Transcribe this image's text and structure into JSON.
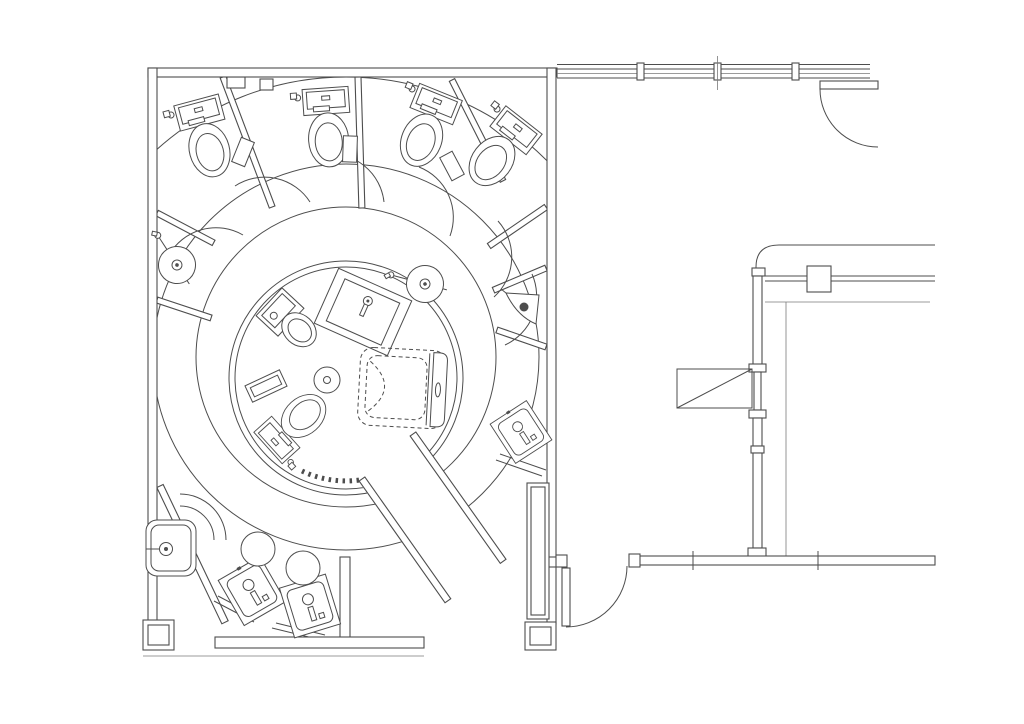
{
  "document": {
    "kind": "architectural floor plan (CAD line drawing, plan view)",
    "scene": "circular restroom suite with radial toilet stalls around a round central wet-room, vanity corner, and an adjacent room to the right",
    "background_color": "#ffffff",
    "line_color": "#4d4d4d",
    "text_visible": false
  },
  "plan": {
    "main_room": {
      "name": "circular-washroom",
      "ring_center": {
        "x": 346,
        "y": 357
      },
      "outer_boundary_radius": 283,
      "ring_radius": 193,
      "corridor_radius": 150,
      "central_room": {
        "center_x": 346,
        "center_y": 378,
        "outer_radius": 117,
        "inner_radius": 111
      },
      "toilet_stall_count": 4,
      "door_arc_count": 8
    },
    "adjacent_room": {
      "name": "side-room",
      "features": [
        "glazed window wall",
        "entry door top-right",
        "entry door bottom-left",
        "counter with block",
        "wall with sidelight",
        "shelf with diagonal"
      ]
    }
  },
  "fixtures": [
    {
      "type": "toilet",
      "name": "toilet-stall-1",
      "x": 196,
      "y": 100,
      "rot": -15
    },
    {
      "type": "toilet",
      "name": "toilet-stall-2",
      "x": 325,
      "y": 88,
      "rot": -4
    },
    {
      "type": "toilet",
      "name": "toilet-stall-3",
      "x": 441,
      "y": 92,
      "rot": 22
    },
    {
      "type": "toilet",
      "name": "toilet-stall-4",
      "x": 524,
      "y": 120,
      "rot": 38
    },
    {
      "type": "toilet",
      "name": "central-toilet",
      "x": 268,
      "y": 448,
      "rot": -132,
      "s": 0.92
    },
    {
      "type": "bidet",
      "name": "central-bidet-sink",
      "x": 280,
      "y": 312,
      "rot": -47
    },
    {
      "type": "fountain",
      "name": "wash-fountain-left",
      "x": 177,
      "y": 265,
      "rot": 12
    },
    {
      "type": "fountain",
      "name": "wash-fountain-right",
      "x": 425,
      "y": 284,
      "rot": -30
    },
    {
      "type": "trisink",
      "name": "corner-sink-triangular",
      "x": 523,
      "y": 307,
      "rot": 0
    },
    {
      "type": "basin",
      "name": "stall-sink-square",
      "x": 521,
      "y": 432,
      "rot": -33,
      "s": 0.9
    },
    {
      "type": "utility",
      "name": "utility-sink",
      "x": 171,
      "y": 548,
      "rot": 0
    },
    {
      "type": "basin",
      "name": "vanity-basin-1",
      "x": 252,
      "y": 591,
      "rot": -30
    },
    {
      "type": "basin",
      "name": "vanity-basin-2",
      "x": 310,
      "y": 606,
      "rot": -17
    },
    {
      "type": "stool",
      "name": "stool-1",
      "x": 258,
      "y": 549,
      "rot": 0
    },
    {
      "type": "stool",
      "name": "stool-2",
      "x": 303,
      "y": 568,
      "rot": 0
    },
    {
      "type": "vanity",
      "name": "central-vanity-sink",
      "x": 363,
      "y": 312,
      "rot": 24
    },
    {
      "type": "tub",
      "name": "bathtub",
      "x": 402,
      "y": 388,
      "rot": 3
    },
    {
      "type": "drain",
      "name": "floor-drain",
      "x": 327,
      "y": 380,
      "rot": 0
    },
    {
      "type": "shelf",
      "name": "central-shelf",
      "x": 266,
      "y": 386,
      "rot": -25
    },
    {
      "type": "tp",
      "name": "tp-holder-1",
      "x": 243,
      "y": 152,
      "rot": 22
    },
    {
      "type": "tp",
      "name": "tp-holder-2",
      "x": 350,
      "y": 149,
      "rot": 2
    },
    {
      "type": "tp",
      "name": "tp-holder-3",
      "x": 452,
      "y": 166,
      "rot": -28
    }
  ]
}
